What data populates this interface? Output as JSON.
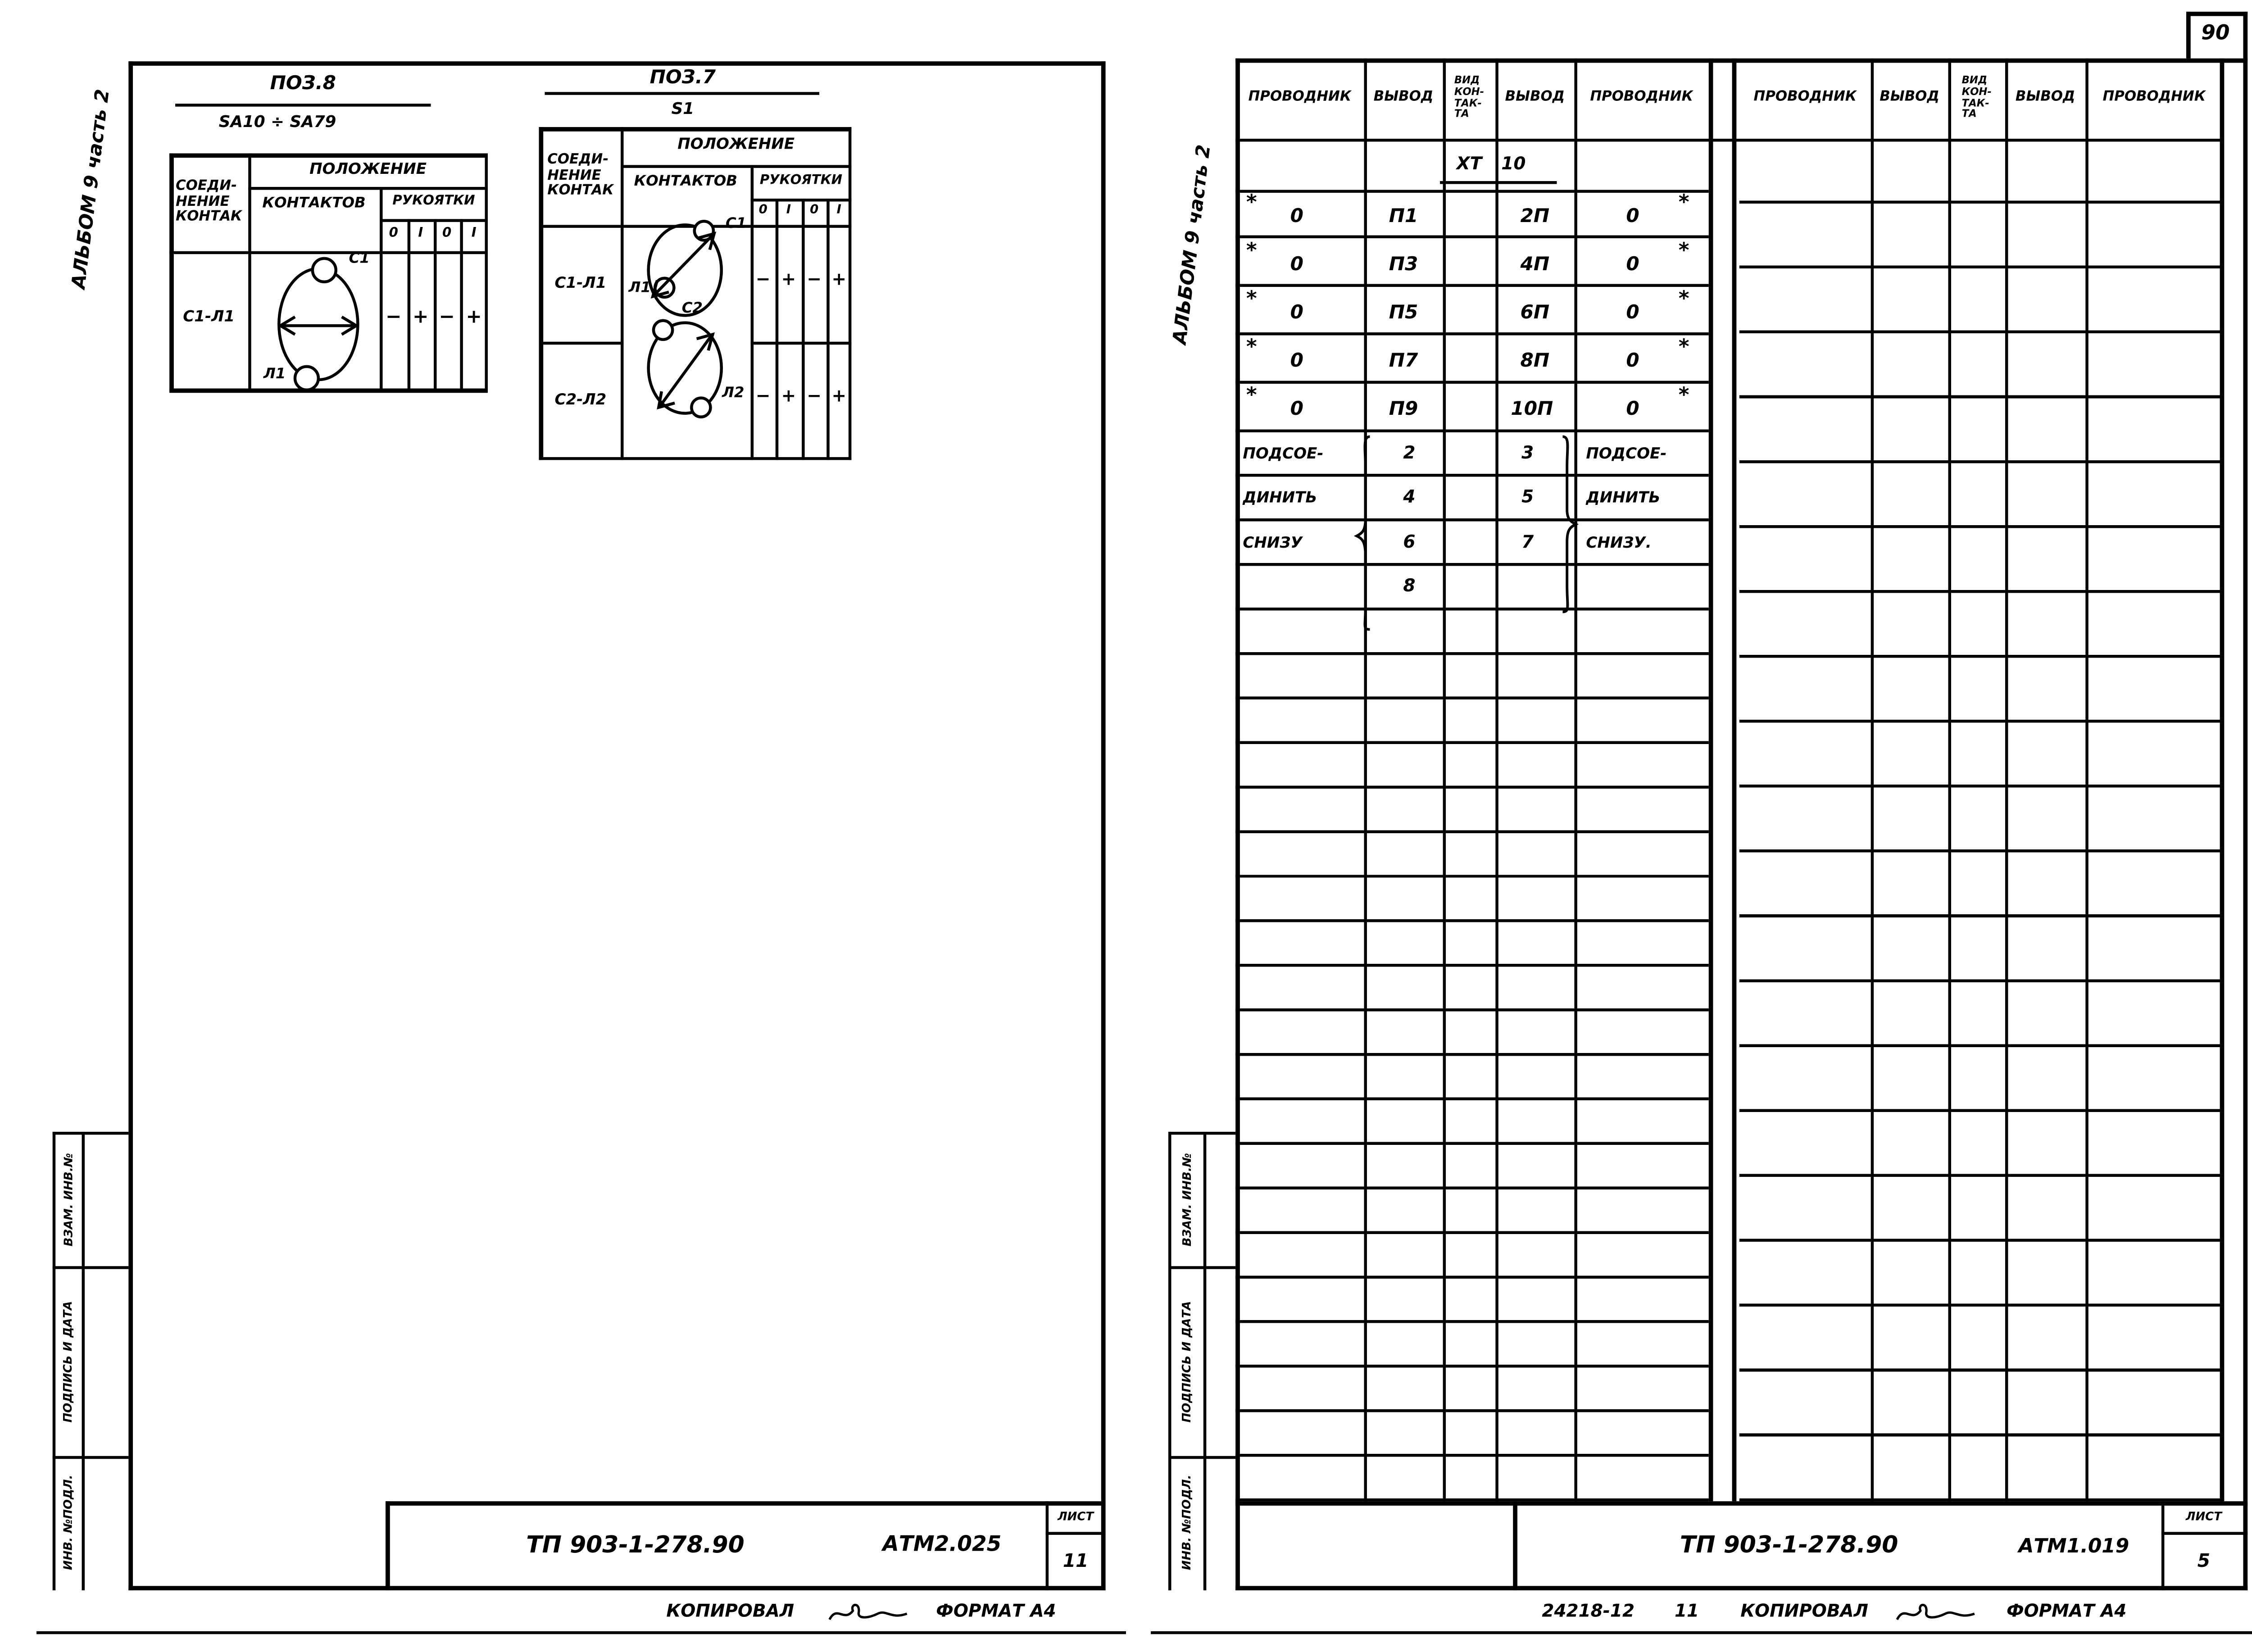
{
  "left_page": {
    "album_label": "АЛЬБОМ 9 часть 2",
    "stamps": {
      "items": [
        {
          "label": "ВЗАМ. ИНВ.№"
        },
        {
          "label": "ПОДПИСЬ И ДАТА"
        },
        {
          "label": "ИНВ. №ПОДЛ."
        }
      ]
    },
    "pos8": {
      "title": "ПОЗ.8",
      "subtitle": "SA10 ÷ SA79",
      "header": {
        "connection_l1": "СОЕДИ-",
        "connection_l2": "НЕНИЕ",
        "connection_l3": "КОНТАК",
        "position": "ПОЛОЖЕНИЕ",
        "contacts": "КОНТАКТОВ",
        "handles": "РУКОЯТКИ",
        "p1": "0",
        "p2": "I",
        "p3": "0",
        "p4": "I"
      },
      "row": {
        "connection": "С1-Л1",
        "top_contact": "С1",
        "bottom_contact": "Л1",
        "v1": "−",
        "v2": "+",
        "v3": "−",
        "v4": "+"
      }
    },
    "pos7": {
      "title": "ПОЗ.7",
      "subtitle": "S1",
      "header": {
        "connection_l1": "СОЕДИ-",
        "connection_l2": "НЕНИЕ",
        "connection_l3": "КОНТАК",
        "position": "ПОЛОЖЕНИЕ",
        "contacts": "КОНТАКТОВ",
        "handles": "РУКОЯТКИ",
        "p1": "0",
        "p2": "I",
        "p3": "0",
        "p4": "I"
      },
      "row1": {
        "connection": "С1-Л1",
        "top_contact": "С1",
        "bottom_contact": "Л1",
        "v1": "−",
        "v2": "+",
        "v3": "−",
        "v4": "+"
      },
      "row2": {
        "connection": "С2-Л2",
        "top_contact": "С2",
        "bottom_contact": "Л2",
        "v1": "−",
        "v2": "+",
        "v3": "−",
        "v4": "+"
      }
    },
    "title_block": {
      "document": "ТП 903-1-278.90",
      "code": "АТМ2.025",
      "sheet_label": "ЛИСТ",
      "sheet_number": "11"
    },
    "footer": {
      "copied_label": "КОПИРОВАЛ",
      "format_label": "ФОРМАТ А4"
    }
  },
  "right_page": {
    "page_number": "90",
    "album_label": "АЛЬБОМ 9 часть 2",
    "stamps": {
      "items": [
        {
          "label": "ВЗАМ. ИНВ.№"
        },
        {
          "label": "ПОДПИСЬ И ДАТА"
        },
        {
          "label": "ИНВ. №ПОДЛ."
        }
      ]
    },
    "table": {
      "headers": {
        "wire": "ПРОВОДНИК",
        "terminal": "ВЫВОД",
        "contact_type_l1": "ВИД",
        "contact_type_l2": "КОН-",
        "contact_type_l3": "ТАК-",
        "contact_type_l4": "ТА"
      },
      "connector": {
        "prefix": "ХТ",
        "number": "10"
      },
      "wire_rows": [
        {
          "star": "*",
          "left_wire": "0",
          "left_terminal": "П1",
          "right_terminal": "2П",
          "right_wire": "0"
        },
        {
          "star": "*",
          "left_wire": "0",
          "left_terminal": "П3",
          "right_terminal": "4П",
          "right_wire": "0"
        },
        {
          "star": "*",
          "left_wire": "0",
          "left_terminal": "П5",
          "right_terminal": "6П",
          "right_wire": "0"
        },
        {
          "star": "*",
          "left_wire": "0",
          "left_terminal": "П7",
          "right_terminal": "8П",
          "right_wire": "0"
        },
        {
          "star": "*",
          "left_wire": "0",
          "left_terminal": "П9",
          "right_terminal": "10П",
          "right_wire": "0"
        }
      ],
      "note_rows": [
        {
          "left_text": "ПОДСОЕ-",
          "left_num": "2",
          "right_num": "3",
          "right_text": "ПОДСОЕ-"
        },
        {
          "left_text": "ДИНИТЬ",
          "left_num": "4",
          "right_num": "5",
          "right_text": "ДИНИТЬ"
        },
        {
          "left_text": "СНИЗУ",
          "left_num": "6",
          "right_num": "7",
          "right_text": "СНИЗУ."
        },
        {
          "left_text": "",
          "left_num": "8",
          "right_num": "",
          "right_text": ""
        }
      ]
    },
    "title_block": {
      "document": "ТП 903-1-278.90",
      "code": "АТМ1.019",
      "sheet_label": "ЛИСТ",
      "sheet_number": "5"
    },
    "footer": {
      "order_number": "24218-12",
      "column_number": "11",
      "copied_label": "КОПИРОВАЛ",
      "format_label": "ФОРМАТ А4"
    }
  }
}
